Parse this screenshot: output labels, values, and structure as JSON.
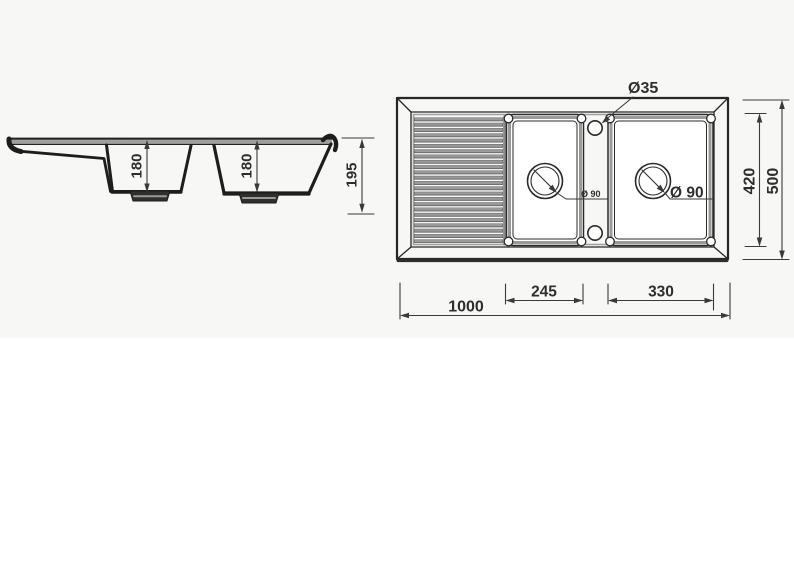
{
  "page": {
    "background": "#ffffff",
    "sheet_tint": "#f7f7f6"
  },
  "drawing": {
    "subject": "double-bowl kitchen sink with drainboard, dimensioned technical drawing",
    "line_color": "#2b2b2b",
    "shade_color": "#9e9e9e",
    "side_view": {
      "bowl1_depth_label": "180",
      "bowl2_depth_label": "180",
      "overall_depth_label": "195"
    },
    "plan_view": {
      "tap_hole_label": "Ø35",
      "small_drain_label": "Ø 90",
      "large_drain_label": "Ø 90",
      "inner_width_label": "420",
      "overall_width_label": "500",
      "middle_bowl_width_label": "245",
      "right_bowl_width_label": "330",
      "overall_length_label": "1000"
    }
  }
}
